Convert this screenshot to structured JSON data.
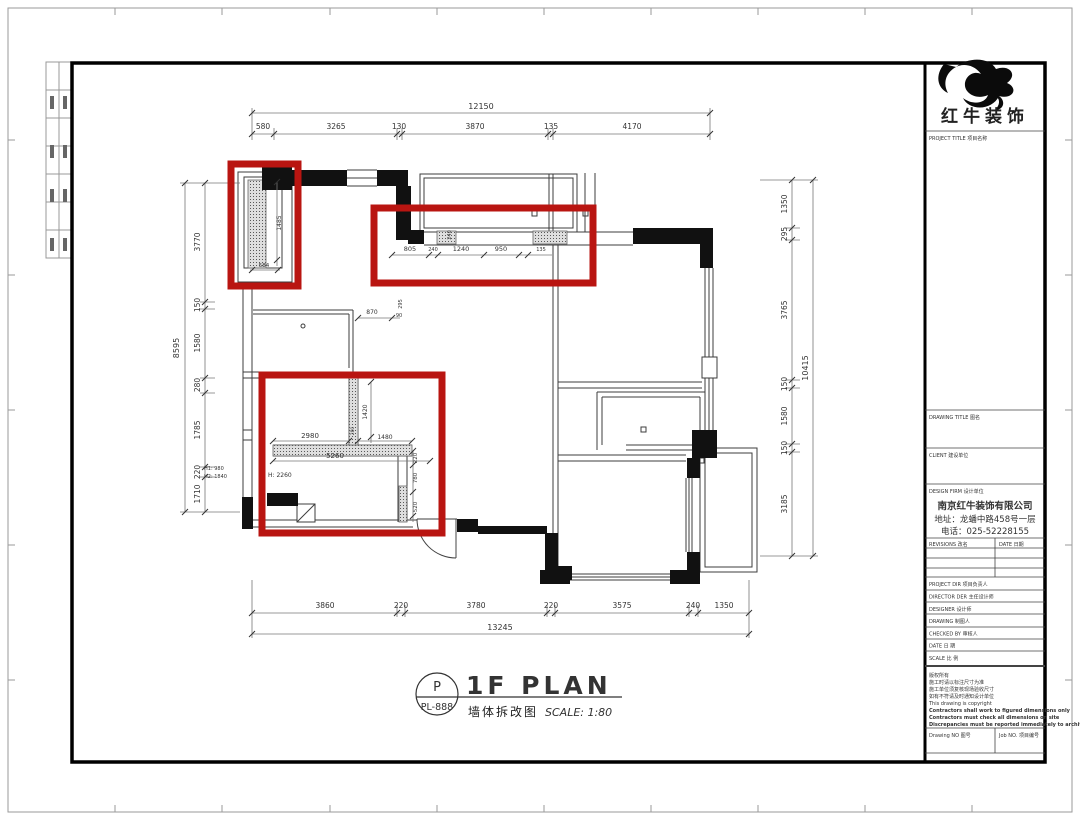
{
  "colors": {
    "highlight_red": "#b91511",
    "wall_black": "#111111",
    "line_gray": "#3c3c3c"
  },
  "title_block": {
    "brand": "红牛装饰",
    "project_title_label": "PROJECT TITLE  项目名称",
    "drawing_title_label": "DRAWING TITLE  图名",
    "client_label": "CLIENT  建设单位",
    "design_firm_label": "DESIGN FIRM  设计单位",
    "company_name": "南京红牛装饰有限公司",
    "company_address": "地址：龙蟠中路458号一层",
    "company_phone": "电话：025-52228155",
    "revisions_label": "REVISIONS  改名",
    "date_col_label": "DATE  日期",
    "rows": [
      "PROJECT DIR   项目负责人",
      "DIRECTOR DER  主任设计师",
      "DESIGNER      设计师",
      "DRAWING       制图人",
      "CHECKED BY    审核人",
      "DATE          日  期",
      "SCALE         比  例"
    ],
    "notes": [
      "版权所有",
      "施工时请以标注尺寸为准",
      "施工单位须复核现场验收尺寸",
      "如有不符请及时通知设计单位",
      "This drawing is copyright",
      "Contractors shall work to figured dimensions only",
      "Contractors must check all dimensions on site",
      "Discrepancies must be reported immediately to architects"
    ],
    "drawing_no_label": "Drawing NO  图号",
    "job_no_label": "Job NO.  项目编号"
  },
  "plan_title": {
    "code_letter": "P",
    "code_number": "PL-888",
    "title_en": "1F PLAN",
    "title_cn": "墙体拆改图",
    "scale": "SCALE: 1:80"
  },
  "dims": {
    "top_total": "12150",
    "top_segments": [
      "580",
      "3265",
      "130",
      "3870",
      "135",
      "4170"
    ],
    "bottom_segments": [
      "3860",
      "220",
      "3780",
      "220",
      "3575",
      "240",
      "1350"
    ],
    "bottom_total": "13245",
    "left_total": "8595",
    "left_segments": [
      "3770",
      "150",
      "1580",
      "280",
      "1785",
      "220",
      "1710"
    ],
    "right_segments": [
      "1350",
      "295",
      "3765",
      "150",
      "1580",
      "150",
      "3185"
    ],
    "right_total": "10415",
    "inner_top_segments": [
      "805",
      "240",
      "1240",
      "950",
      "135"
    ],
    "inner_top_rotated": "240",
    "cabinet_height": "1485",
    "cabinet_width": "584",
    "room_width": "870",
    "room_offset": "90",
    "room_rotated": "295",
    "demo_a": "2980",
    "demo_b": "1480",
    "demo_c": "5260",
    "demo_d": "1420",
    "demo_e": "280",
    "side_a": "220",
    "side_b": "780",
    "side_c": "520",
    "height_note": "H: 2260",
    "h1": "H1: 980",
    "h2": "H2: 1840"
  }
}
